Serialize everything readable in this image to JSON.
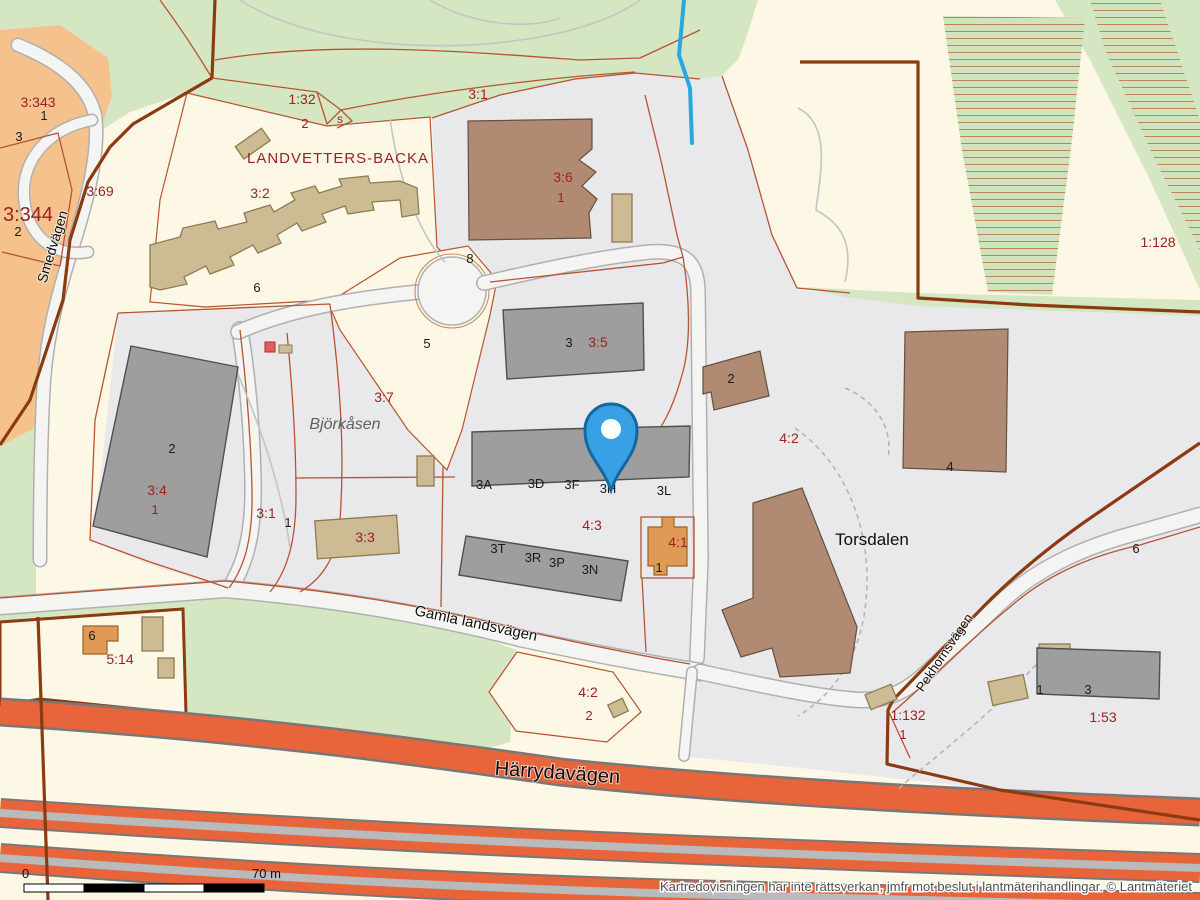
{
  "map": {
    "disclaimer": "Kartredovisningen har inte rättsverkan, jmfr mot beslut i lantmäterihandlingar. © Lantmäteriet",
    "scale_bar": {
      "start": "0",
      "end": "70 m",
      "segments": 4
    },
    "marker": {
      "name": "location-pin",
      "color": "#38a1e6"
    },
    "colors": {
      "forest": "#d5e7c2",
      "land": "#fdf8e6",
      "urban": "#e9e9ec",
      "residential": "#f5c28e",
      "highway": "#e8643a",
      "highway_median": "#b9babc",
      "boundary": "#8c3a10",
      "water": "#29a8e0",
      "lblred": "#9c2121",
      "bldg_tan": "#cdbb94",
      "bldg_brown": "#b08a72",
      "bldg_gray": "#9e9e9e",
      "bldg_orange": "#e09a55"
    },
    "labels": [
      {
        "t": "3:343",
        "x": 38,
        "y": 107,
        "s": 14,
        "cls": "red"
      },
      {
        "t": "1",
        "x": 44,
        "y": 120,
        "s": 13,
        "cls": "blk"
      },
      {
        "t": "3",
        "x": 19,
        "y": 141,
        "s": 13,
        "cls": "blk"
      },
      {
        "t": "3:344",
        "x": 28,
        "y": 221,
        "s": 20,
        "cls": "red"
      },
      {
        "t": "2",
        "x": 18,
        "y": 236,
        "s": 13,
        "cls": "blk"
      },
      {
        "t": "3:69",
        "x": 100,
        "y": 196,
        "s": 14,
        "cls": "red"
      },
      {
        "t": "Smedvägen",
        "x": 57,
        "y": 248,
        "s": 14,
        "cls": "street",
        "rot": -73
      },
      {
        "t": "1:32",
        "x": 302,
        "y": 104,
        "s": 14,
        "cls": "red"
      },
      {
        "t": "2",
        "x": 305,
        "y": 128,
        "s": 13,
        "cls": "red"
      },
      {
        "t": "s",
        "x": 340,
        "y": 123,
        "s": 12,
        "cls": "red"
      },
      {
        "t": "3:1",
        "x": 478,
        "y": 99,
        "s": 14,
        "cls": "red"
      },
      {
        "t": "LANDVETTERS-BACKA",
        "x": 338,
        "y": 163,
        "s": 15,
        "cls": "farm"
      },
      {
        "t": "3:2",
        "x": 260,
        "y": 198,
        "s": 14,
        "cls": "red"
      },
      {
        "t": "3:6",
        "x": 563,
        "y": 182,
        "s": 14,
        "cls": "red"
      },
      {
        "t": "1",
        "x": 561,
        "y": 202,
        "s": 13,
        "cls": "red"
      },
      {
        "t": "1:128",
        "x": 1158,
        "y": 247,
        "s": 14,
        "cls": "red"
      },
      {
        "t": "8",
        "x": 470,
        "y": 263,
        "s": 13,
        "cls": "blk"
      },
      {
        "t": "6",
        "x": 257,
        "y": 292,
        "s": 13,
        "cls": "blk"
      },
      {
        "t": "5",
        "x": 427,
        "y": 348,
        "s": 13,
        "cls": "blk"
      },
      {
        "t": "3",
        "x": 569,
        "y": 347,
        "s": 13,
        "cls": "blk"
      },
      {
        "t": "3:5",
        "x": 598,
        "y": 347,
        "s": 14,
        "cls": "red"
      },
      {
        "t": "3:7",
        "x": 384,
        "y": 402,
        "s": 14,
        "cls": "red"
      },
      {
        "t": "Björkåsen",
        "x": 345,
        "y": 429,
        "s": 16,
        "cls": "place_it"
      },
      {
        "t": "2",
        "x": 731,
        "y": 383,
        "s": 13,
        "cls": "blk"
      },
      {
        "t": "4:2",
        "x": 789,
        "y": 443,
        "s": 14,
        "cls": "red"
      },
      {
        "t": "2",
        "x": 172,
        "y": 453,
        "s": 13,
        "cls": "blk"
      },
      {
        "t": "3:4",
        "x": 157,
        "y": 495,
        "s": 14,
        "cls": "red"
      },
      {
        "t": "1",
        "x": 155,
        "y": 514,
        "s": 13,
        "cls": "red"
      },
      {
        "t": "3:1",
        "x": 266,
        "y": 518,
        "s": 14,
        "cls": "red"
      },
      {
        "t": "1",
        "x": 288,
        "y": 527,
        "s": 13,
        "cls": "blk"
      },
      {
        "t": "3:3",
        "x": 365,
        "y": 542,
        "s": 14,
        "cls": "red"
      },
      {
        "t": "3A",
        "x": 484,
        "y": 489,
        "s": 13,
        "cls": "blk"
      },
      {
        "t": "3D",
        "x": 536,
        "y": 488,
        "s": 13,
        "cls": "blk"
      },
      {
        "t": "3F",
        "x": 572,
        "y": 489,
        "s": 13,
        "cls": "blk"
      },
      {
        "t": "3H",
        "x": 608,
        "y": 493,
        "s": 13,
        "cls": "blk"
      },
      {
        "t": "3L",
        "x": 664,
        "y": 495,
        "s": 13,
        "cls": "blk"
      },
      {
        "t": "4:3",
        "x": 592,
        "y": 530,
        "s": 14,
        "cls": "red"
      },
      {
        "t": "4:1",
        "x": 678,
        "y": 547,
        "s": 14,
        "cls": "red"
      },
      {
        "t": "1",
        "x": 659,
        "y": 572,
        "s": 13,
        "cls": "blk"
      },
      {
        "t": "3T",
        "x": 498,
        "y": 553,
        "s": 13,
        "cls": "blk"
      },
      {
        "t": "3R",
        "x": 533,
        "y": 562,
        "s": 13,
        "cls": "blk"
      },
      {
        "t": "3P",
        "x": 557,
        "y": 567,
        "s": 13,
        "cls": "blk"
      },
      {
        "t": "3N",
        "x": 590,
        "y": 574,
        "s": 13,
        "cls": "blk"
      },
      {
        "t": "Torsdalen",
        "x": 872,
        "y": 545,
        "s": 17,
        "cls": "place"
      },
      {
        "t": "4",
        "x": 950,
        "y": 471,
        "s": 13,
        "cls": "blk"
      },
      {
        "t": "6",
        "x": 1136,
        "y": 553,
        "s": 13,
        "cls": "blk"
      },
      {
        "t": "6",
        "x": 92,
        "y": 640,
        "s": 13,
        "cls": "blk"
      },
      {
        "t": "5:14",
        "x": 120,
        "y": 664,
        "s": 14,
        "cls": "red"
      },
      {
        "t": "Gamla landsvägen",
        "x": 475,
        "y": 628,
        "s": 15,
        "cls": "street",
        "rot": 12
      },
      {
        "t": "4:2",
        "x": 588,
        "y": 697,
        "s": 14,
        "cls": "red"
      },
      {
        "t": "2",
        "x": 589,
        "y": 720,
        "s": 13,
        "cls": "red"
      },
      {
        "t": "Härrydavägen",
        "x": 557,
        "y": 779,
        "s": 20,
        "cls": "street",
        "rot": 4
      },
      {
        "t": "Pekhornsvägen",
        "x": 948,
        "y": 655,
        "s": 13,
        "cls": "street",
        "rot": -56
      },
      {
        "t": "1:132",
        "x": 908,
        "y": 720,
        "s": 14,
        "cls": "red"
      },
      {
        "t": "1",
        "x": 903,
        "y": 739,
        "s": 13,
        "cls": "red"
      },
      {
        "t": "1:53",
        "x": 1103,
        "y": 722,
        "s": 14,
        "cls": "red"
      },
      {
        "t": "1",
        "x": 1040,
        "y": 694,
        "s": 13,
        "cls": "blk"
      },
      {
        "t": "3",
        "x": 1088,
        "y": 694,
        "s": 13,
        "cls": "blk"
      }
    ]
  }
}
